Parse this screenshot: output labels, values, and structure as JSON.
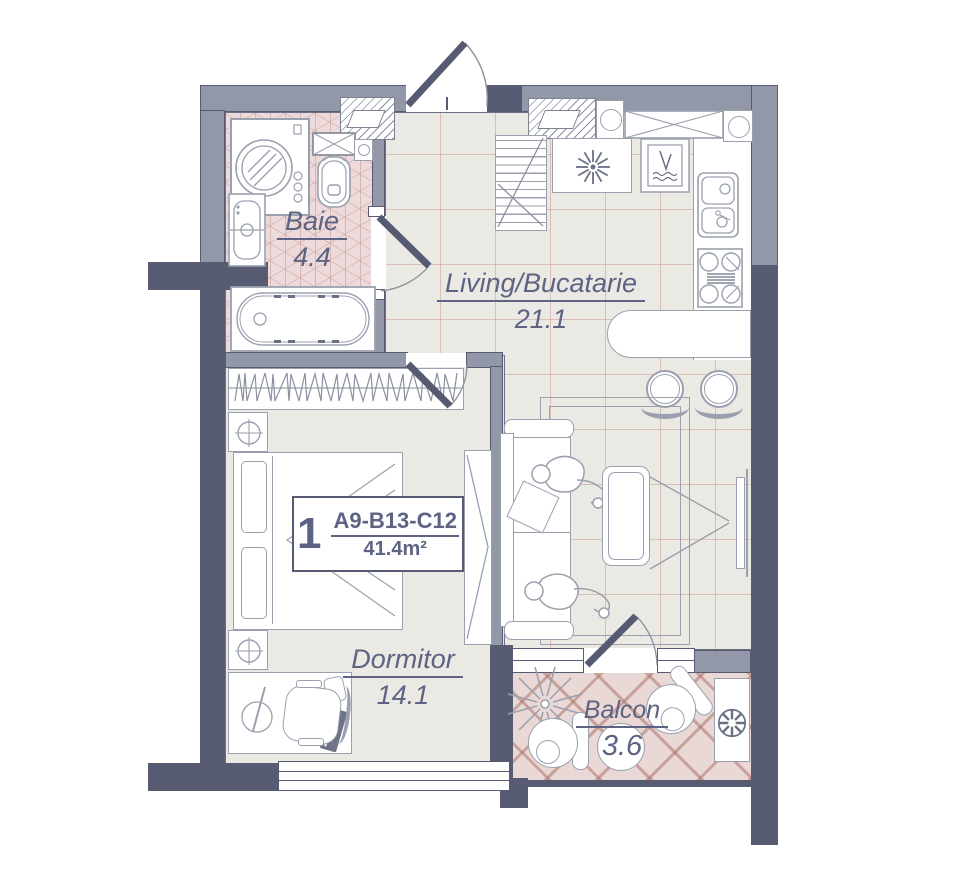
{
  "unit": {
    "number": "1",
    "code": "A9-B13-C12",
    "area": "41.4m²"
  },
  "rooms": {
    "baie": {
      "name": "Baie",
      "area": "4.4"
    },
    "living": {
      "name": "Living/Bucatarie",
      "area": "21.1"
    },
    "dormitor": {
      "name": "Dormitor",
      "area": "14.1"
    },
    "balcon": {
      "name": "Balcon",
      "area": "3.6"
    }
  },
  "colors": {
    "wall_dark": "#575c72",
    "wall_light": "#9298a8",
    "floor": "#ebe9e3",
    "bath_floor": "#eddbdb",
    "balcony_floor": "#e9d8d5",
    "label_text": "#5d6382",
    "furniture_line": "#9aa0ae"
  },
  "symbols": [
    "washing-machine",
    "toilet",
    "bath-sink",
    "bathtub",
    "vent-shaft",
    "wardrobe-rack",
    "nightstand-lamp",
    "double-bed",
    "desk",
    "office-chair",
    "laptop",
    "sliding-wardrobe",
    "kitchen-shelf",
    "dining-table",
    "dishwasher",
    "kitchen-sink",
    "stove",
    "bar-counter",
    "bar-stool",
    "sofa",
    "person",
    "pillow",
    "coffee-table",
    "rug",
    "tv",
    "entry-door",
    "interior-door",
    "window",
    "plant",
    "armchair",
    "round-table",
    "ac-unit"
  ]
}
